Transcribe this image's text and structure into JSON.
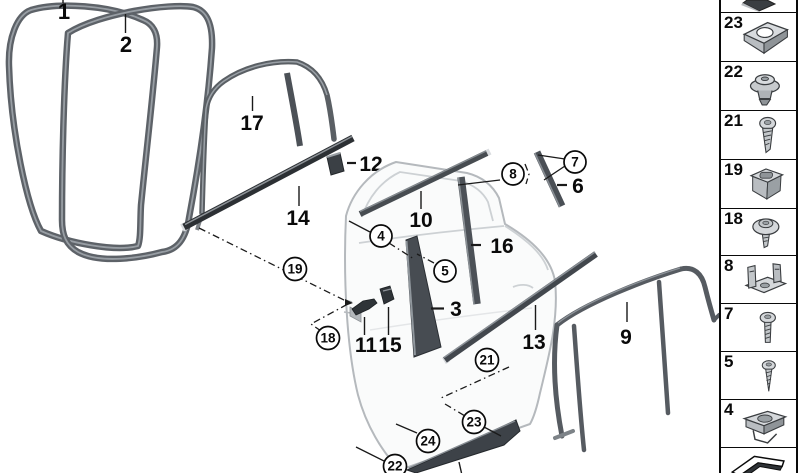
{
  "diagram": {
    "labels": {
      "n1": "1",
      "n2": "2",
      "n3": "3",
      "n6": "6",
      "n9": "9",
      "n10": "10",
      "n11": "11",
      "n12": "12",
      "n13": "13",
      "n14": "14",
      "n15": "15",
      "n16": "16",
      "n17": "17"
    },
    "callouts": {
      "c4": "4",
      "c5": "5",
      "c7": "7",
      "c8": "8",
      "c18": "18",
      "c19": "19",
      "c21": "21",
      "c22": "22",
      "c23": "23",
      "c24": "24"
    },
    "colors": {
      "trim_dark": "#2c3034",
      "part_gray": "#4a4f55",
      "seal_gray": "#5d6268",
      "door_outline": "#b5b9bd",
      "line_black": "#1a1a1a"
    }
  },
  "sidebar": {
    "cells": [
      {
        "number": "",
        "icon": "clip-partial-icon"
      },
      {
        "number": "23",
        "icon": "speed-nut-icon"
      },
      {
        "number": "22",
        "icon": "grommet-icon"
      },
      {
        "number": "21",
        "icon": "torx-screw-icon"
      },
      {
        "number": "19",
        "icon": "cage-nut-icon"
      },
      {
        "number": "18",
        "icon": "washer-screw-icon"
      },
      {
        "number": "8",
        "icon": "bracket-clip-icon"
      },
      {
        "number": "7",
        "icon": "pan-screw-icon"
      },
      {
        "number": "5",
        "icon": "tapping-screw-icon"
      },
      {
        "number": "4",
        "icon": "clip-nut-icon"
      },
      {
        "number": "",
        "icon": "page-arrow-icon"
      }
    ]
  }
}
